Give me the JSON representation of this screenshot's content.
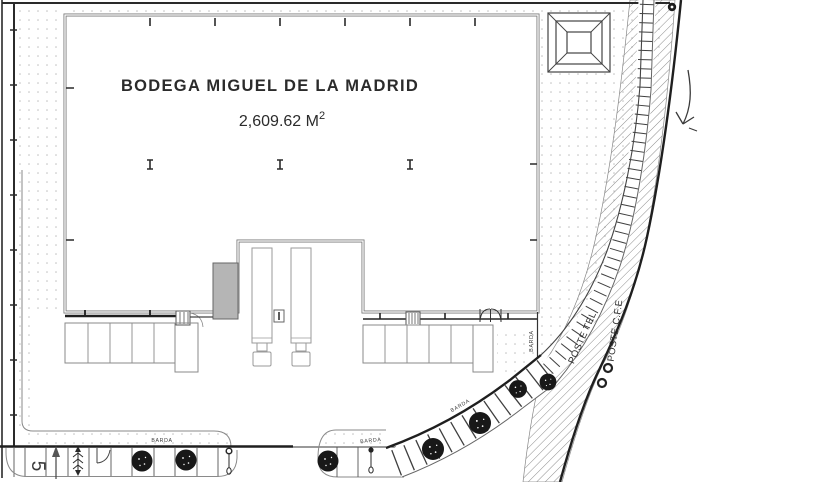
{
  "drawing": {
    "title": "BODEGA MIGUEL DE LA MADRID",
    "area": {
      "value": "2,609.62 M",
      "sup": "2"
    },
    "labels": {
      "barda": "BARDA",
      "poste_tel": "POSTE TEL",
      "poste_cfe": "POSTE C.F.E",
      "stall_number": "5"
    },
    "colors": {
      "line": "#2a2a2a",
      "wall": "#7a7a7a",
      "ramp_fill": "#b5b5b5",
      "tree": "#181818",
      "background": "#ffffff"
    }
  }
}
